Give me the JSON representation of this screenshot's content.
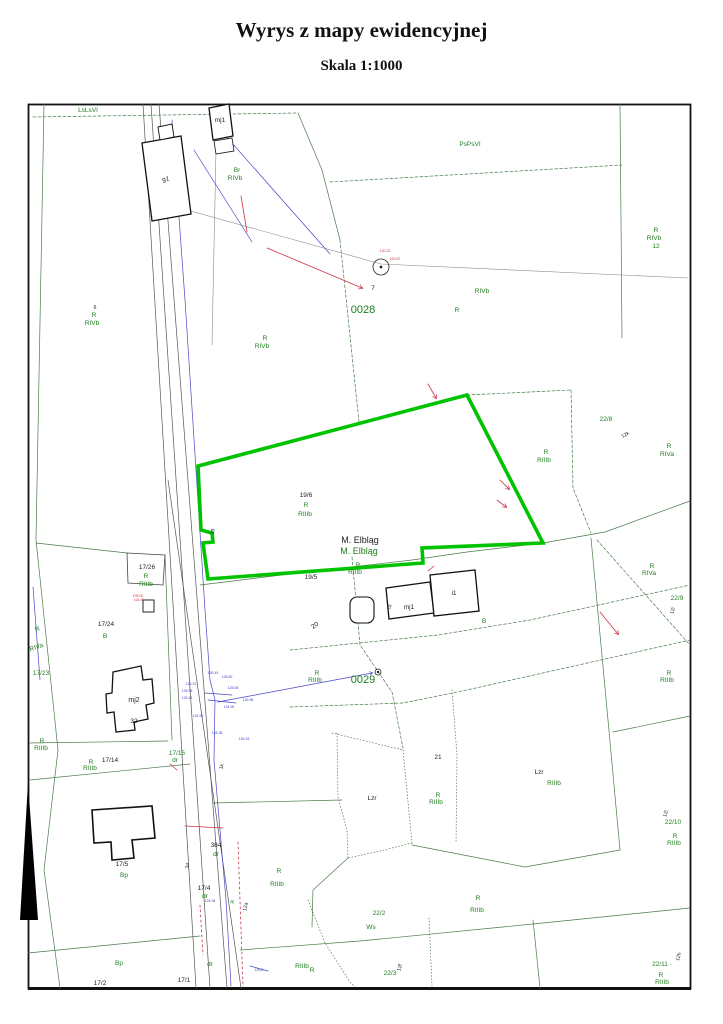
{
  "header": {
    "title": "Wyrys z mapy ewidencyjnej",
    "subtitle": "Skala 1:1000"
  },
  "map": {
    "highlighted_parcel": {
      "parcel_number": "19/6",
      "land_use": "R RIIIb",
      "municipality": "M. Elbląg",
      "outline_color": "#00c300"
    },
    "colors": {
      "g": "#1e7d1e",
      "k": "#222222",
      "b": "#4747c8",
      "r": "#cc3344",
      "boundary": "#4a7a4a",
      "road": "#555555",
      "highlight": "#00c300"
    },
    "labels": [
      {
        "t": "LsLsVI",
        "x": 88,
        "y": 112,
        "c": "g"
      },
      {
        "t": "mj1",
        "x": 220,
        "y": 122,
        "c": "k"
      },
      {
        "t": "g1",
        "x": 166,
        "y": 181,
        "c": "k",
        "r": -8
      },
      {
        "t": "Br",
        "x": 237,
        "y": 172,
        "c": "g"
      },
      {
        "t": "RIVb",
        "x": 235,
        "y": 180,
        "c": "g"
      },
      {
        "t": "PsPsVI",
        "x": 470,
        "y": 146,
        "c": "g"
      },
      {
        "t": "R",
        "x": 656,
        "y": 232,
        "c": "g"
      },
      {
        "t": "RIVb",
        "x": 654,
        "y": 240,
        "c": "g"
      },
      {
        "t": "12",
        "x": 656,
        "y": 248,
        "c": "g"
      },
      {
        "t": "7",
        "x": 373,
        "y": 290,
        "c": "k"
      },
      {
        "t": "0028",
        "x": 363,
        "y": 313,
        "c": "g",
        "s": 11
      },
      {
        "t": "RIVb",
        "x": 482,
        "y": 293,
        "c": "g"
      },
      {
        "t": "R",
        "x": 457,
        "y": 312,
        "c": "g"
      },
      {
        "t": "6",
        "x": 95,
        "y": 309,
        "c": "k",
        "s": 5
      },
      {
        "t": "R",
        "x": 94,
        "y": 317,
        "c": "g"
      },
      {
        "t": "RIVb",
        "x": 92,
        "y": 325,
        "c": "g"
      },
      {
        "t": "R",
        "x": 265,
        "y": 340,
        "c": "g"
      },
      {
        "t": "RIVb",
        "x": 262,
        "y": 348,
        "c": "g"
      },
      {
        "t": "120.22",
        "x": 385,
        "y": 252,
        "c": "r",
        "s": 3.5
      },
      {
        "t": "220.87",
        "x": 395,
        "y": 260,
        "c": "r",
        "s": 3.5
      },
      {
        "t": "22/8",
        "x": 606,
        "y": 421,
        "c": "g"
      },
      {
        "t": "12k",
        "x": 626,
        "y": 436,
        "c": "k",
        "r": -30,
        "s": 5
      },
      {
        "t": "R",
        "x": 669,
        "y": 448,
        "c": "g"
      },
      {
        "t": "RIVa",
        "x": 667,
        "y": 456,
        "c": "g"
      },
      {
        "t": "19/6",
        "x": 306,
        "y": 497,
        "c": "k"
      },
      {
        "t": "R",
        "x": 306,
        "y": 507,
        "c": "g"
      },
      {
        "t": "RIIIb",
        "x": 305,
        "y": 516,
        "c": "g"
      },
      {
        "t": "19",
        "x": 214,
        "y": 532,
        "c": "k",
        "r": -75,
        "s": 5
      },
      {
        "t": "M. Elbląg",
        "x": 360,
        "y": 543,
        "c": "k",
        "s": 9
      },
      {
        "t": "M. Elbląg",
        "x": 359,
        "y": 554,
        "c": "g",
        "s": 9
      },
      {
        "t": "R",
        "x": 546,
        "y": 454,
        "c": "g"
      },
      {
        "t": "RIIIb",
        "x": 544,
        "y": 462,
        "c": "g"
      },
      {
        "t": "R",
        "x": 652,
        "y": 568,
        "c": "g"
      },
      {
        "t": "RIVa",
        "x": 649,
        "y": 575,
        "c": "g"
      },
      {
        "t": "22/9",
        "x": 677,
        "y": 600,
        "c": "g"
      },
      {
        "t": "12i",
        "x": 674,
        "y": 611,
        "c": "k",
        "r": -75,
        "s": 5
      },
      {
        "t": "R",
        "x": 669,
        "y": 675,
        "c": "g"
      },
      {
        "t": "RIIIb",
        "x": 667,
        "y": 682,
        "c": "g"
      },
      {
        "t": "17/26",
        "x": 147,
        "y": 569,
        "c": "k"
      },
      {
        "t": "R",
        "x": 146,
        "y": 578,
        "c": "g"
      },
      {
        "t": "RIIIb",
        "x": 146,
        "y": 586,
        "c": "g"
      },
      {
        "t": "105.00",
        "x": 138,
        "y": 597,
        "c": "r",
        "s": 3.5
      },
      {
        "t": "104.99",
        "x": 139,
        "y": 601,
        "c": "r",
        "s": 3.5
      },
      {
        "t": "17/24",
        "x": 106,
        "y": 626,
        "c": "k"
      },
      {
        "t": "B",
        "x": 105,
        "y": 638,
        "c": "g"
      },
      {
        "t": "R",
        "x": 38,
        "y": 631,
        "c": "g",
        "r": -20
      },
      {
        "t": "RIVa",
        "x": 37,
        "y": 649,
        "c": "g",
        "r": -20
      },
      {
        "t": "17/23",
        "x": 41,
        "y": 675,
        "c": "g"
      },
      {
        "t": "mj2",
        "x": 134,
        "y": 702,
        "c": "k",
        "s": 7
      },
      {
        "t": "32",
        "x": 134,
        "y": 723,
        "c": "k"
      },
      {
        "t": "R",
        "x": 358,
        "y": 567,
        "c": "g"
      },
      {
        "t": "RIIIb",
        "x": 355,
        "y": 574,
        "c": "g"
      },
      {
        "t": "19/5",
        "x": 311,
        "y": 579,
        "c": "k"
      },
      {
        "t": "iS",
        "x": 391,
        "y": 607,
        "c": "k",
        "r": -75,
        "s": 5
      },
      {
        "t": "mj1",
        "x": 409,
        "y": 609,
        "c": "k"
      },
      {
        "t": "i1",
        "x": 454,
        "y": 595,
        "c": "k"
      },
      {
        "t": "B",
        "x": 484,
        "y": 623,
        "c": "g"
      },
      {
        "t": "20",
        "x": 316,
        "y": 627,
        "c": "k",
        "r": -35
      },
      {
        "t": "R",
        "x": 317,
        "y": 675,
        "c": "g"
      },
      {
        "t": "RIIIb",
        "x": 315,
        "y": 682,
        "c": "g"
      },
      {
        "t": "0029",
        "x": 363,
        "y": 683,
        "c": "g",
        "s": 11
      },
      {
        "t": "126.49",
        "x": 213,
        "y": 674,
        "c": "b",
        "s": 3.5
      },
      {
        "t": "126.50",
        "x": 227,
        "y": 678,
        "c": "b",
        "s": 3.5
      },
      {
        "t": "126.31",
        "x": 191,
        "y": 685,
        "c": "b",
        "s": 3.5
      },
      {
        "t": "125.99",
        "x": 187,
        "y": 692,
        "c": "b",
        "s": 3.5
      },
      {
        "t": "126.48",
        "x": 187,
        "y": 699,
        "c": "b",
        "s": 3.5
      },
      {
        "t": "125.08",
        "x": 233,
        "y": 689,
        "c": "b",
        "s": 3.5
      },
      {
        "t": "126.98",
        "x": 248,
        "y": 701,
        "c": "b",
        "s": 3.5
      },
      {
        "t": "124.95",
        "x": 229,
        "y": 708,
        "c": "b",
        "s": 3.5
      },
      {
        "t": "124.99",
        "x": 198,
        "y": 717,
        "c": "b",
        "s": 3.5
      },
      {
        "t": "124.38",
        "x": 217,
        "y": 734,
        "c": "b",
        "s": 3.5
      },
      {
        "t": "126.34",
        "x": 244,
        "y": 740,
        "c": "b",
        "s": 3.5
      },
      {
        "t": "124.08",
        "x": 210,
        "y": 902,
        "c": "b",
        "s": 3.5
      },
      {
        "t": "126.6",
        "x": 259,
        "y": 971,
        "c": "b",
        "s": 3.5
      },
      {
        "t": "17/15",
        "x": 177,
        "y": 755,
        "c": "g"
      },
      {
        "t": "dr",
        "x": 175,
        "y": 762,
        "c": "g"
      },
      {
        "t": "1k",
        "x": 223,
        "y": 767,
        "c": "k",
        "r": -75,
        "s": 5
      },
      {
        "t": "R",
        "x": 42,
        "y": 743,
        "c": "g"
      },
      {
        "t": "RIIIb",
        "x": 41,
        "y": 750,
        "c": "g"
      },
      {
        "t": "R",
        "x": 91,
        "y": 764,
        "c": "g"
      },
      {
        "t": "17/14",
        "x": 110,
        "y": 762,
        "c": "k"
      },
      {
        "t": "RIIIb",
        "x": 90,
        "y": 770,
        "c": "g"
      },
      {
        "t": "17/5",
        "x": 122,
        "y": 866,
        "c": "k"
      },
      {
        "t": "Bp",
        "x": 124,
        "y": 877,
        "c": "g"
      },
      {
        "t": "34",
        "x": 189,
        "y": 866,
        "c": "k",
        "r": -80,
        "s": 5
      },
      {
        "t": "384",
        "x": 216,
        "y": 847,
        "c": "k"
      },
      {
        "t": "dr",
        "x": 216,
        "y": 856,
        "c": "g"
      },
      {
        "t": "17/4",
        "x": 204,
        "y": 890,
        "c": "k"
      },
      {
        "t": "dr",
        "x": 205,
        "y": 898,
        "c": "g"
      },
      {
        "t": "R",
        "x": 234,
        "y": 902,
        "c": "g",
        "r": -80,
        "s": 5
      },
      {
        "t": "12a",
        "x": 247,
        "y": 907,
        "c": "k",
        "r": -80,
        "s": 5
      },
      {
        "t": "R",
        "x": 279,
        "y": 873,
        "c": "g"
      },
      {
        "t": "RIIIb",
        "x": 277,
        "y": 886,
        "c": "g"
      },
      {
        "t": "Lzr",
        "x": 372,
        "y": 800,
        "c": "k"
      },
      {
        "t": "21",
        "x": 438,
        "y": 759,
        "c": "k"
      },
      {
        "t": "R",
        "x": 438,
        "y": 797,
        "c": "g"
      },
      {
        "t": "RIIIb",
        "x": 436,
        "y": 804,
        "c": "g"
      },
      {
        "t": "22/2",
        "x": 379,
        "y": 915,
        "c": "g"
      },
      {
        "t": "Ws",
        "x": 371,
        "y": 929,
        "c": "g"
      },
      {
        "t": "R",
        "x": 478,
        "y": 900,
        "c": "g"
      },
      {
        "t": "RIIIb",
        "x": 477,
        "y": 912,
        "c": "g"
      },
      {
        "t": "Lzr",
        "x": 539,
        "y": 774,
        "c": "k"
      },
      {
        "t": "RIIIb",
        "x": 554,
        "y": 785,
        "c": "g"
      },
      {
        "t": "12i",
        "x": 667,
        "y": 814,
        "c": "k",
        "r": -75,
        "s": 5
      },
      {
        "t": "22/10",
        "x": 673,
        "y": 824,
        "c": "g"
      },
      {
        "t": "R",
        "x": 675,
        "y": 838,
        "c": "g"
      },
      {
        "t": "RIIIb",
        "x": 674,
        "y": 845,
        "c": "g"
      },
      {
        "t": "Bp",
        "x": 119,
        "y": 965,
        "c": "g"
      },
      {
        "t": "17/2",
        "x": 100,
        "y": 985,
        "c": "k"
      },
      {
        "t": "17/1",
        "x": 184,
        "y": 982,
        "c": "k"
      },
      {
        "t": "dr",
        "x": 210,
        "y": 966,
        "c": "g"
      },
      {
        "t": "RIIIb",
        "x": 302,
        "y": 968,
        "c": "g"
      },
      {
        "t": "R",
        "x": 312,
        "y": 972,
        "c": "g"
      },
      {
        "t": "22/3",
        "x": 390,
        "y": 975,
        "c": "g"
      },
      {
        "t": "12f",
        "x": 401,
        "y": 968,
        "c": "k",
        "r": -75,
        "s": 5
      },
      {
        "t": "22/11 ·",
        "x": 662,
        "y": 966,
        "c": "g"
      },
      {
        "t": "12h",
        "x": 680,
        "y": 957,
        "c": "k",
        "r": -75,
        "s": 5
      },
      {
        "t": "R",
        "x": 661,
        "y": 977,
        "c": "g"
      },
      {
        "t": "RIIIb",
        "x": 662,
        "y": 984,
        "c": "g"
      }
    ]
  }
}
